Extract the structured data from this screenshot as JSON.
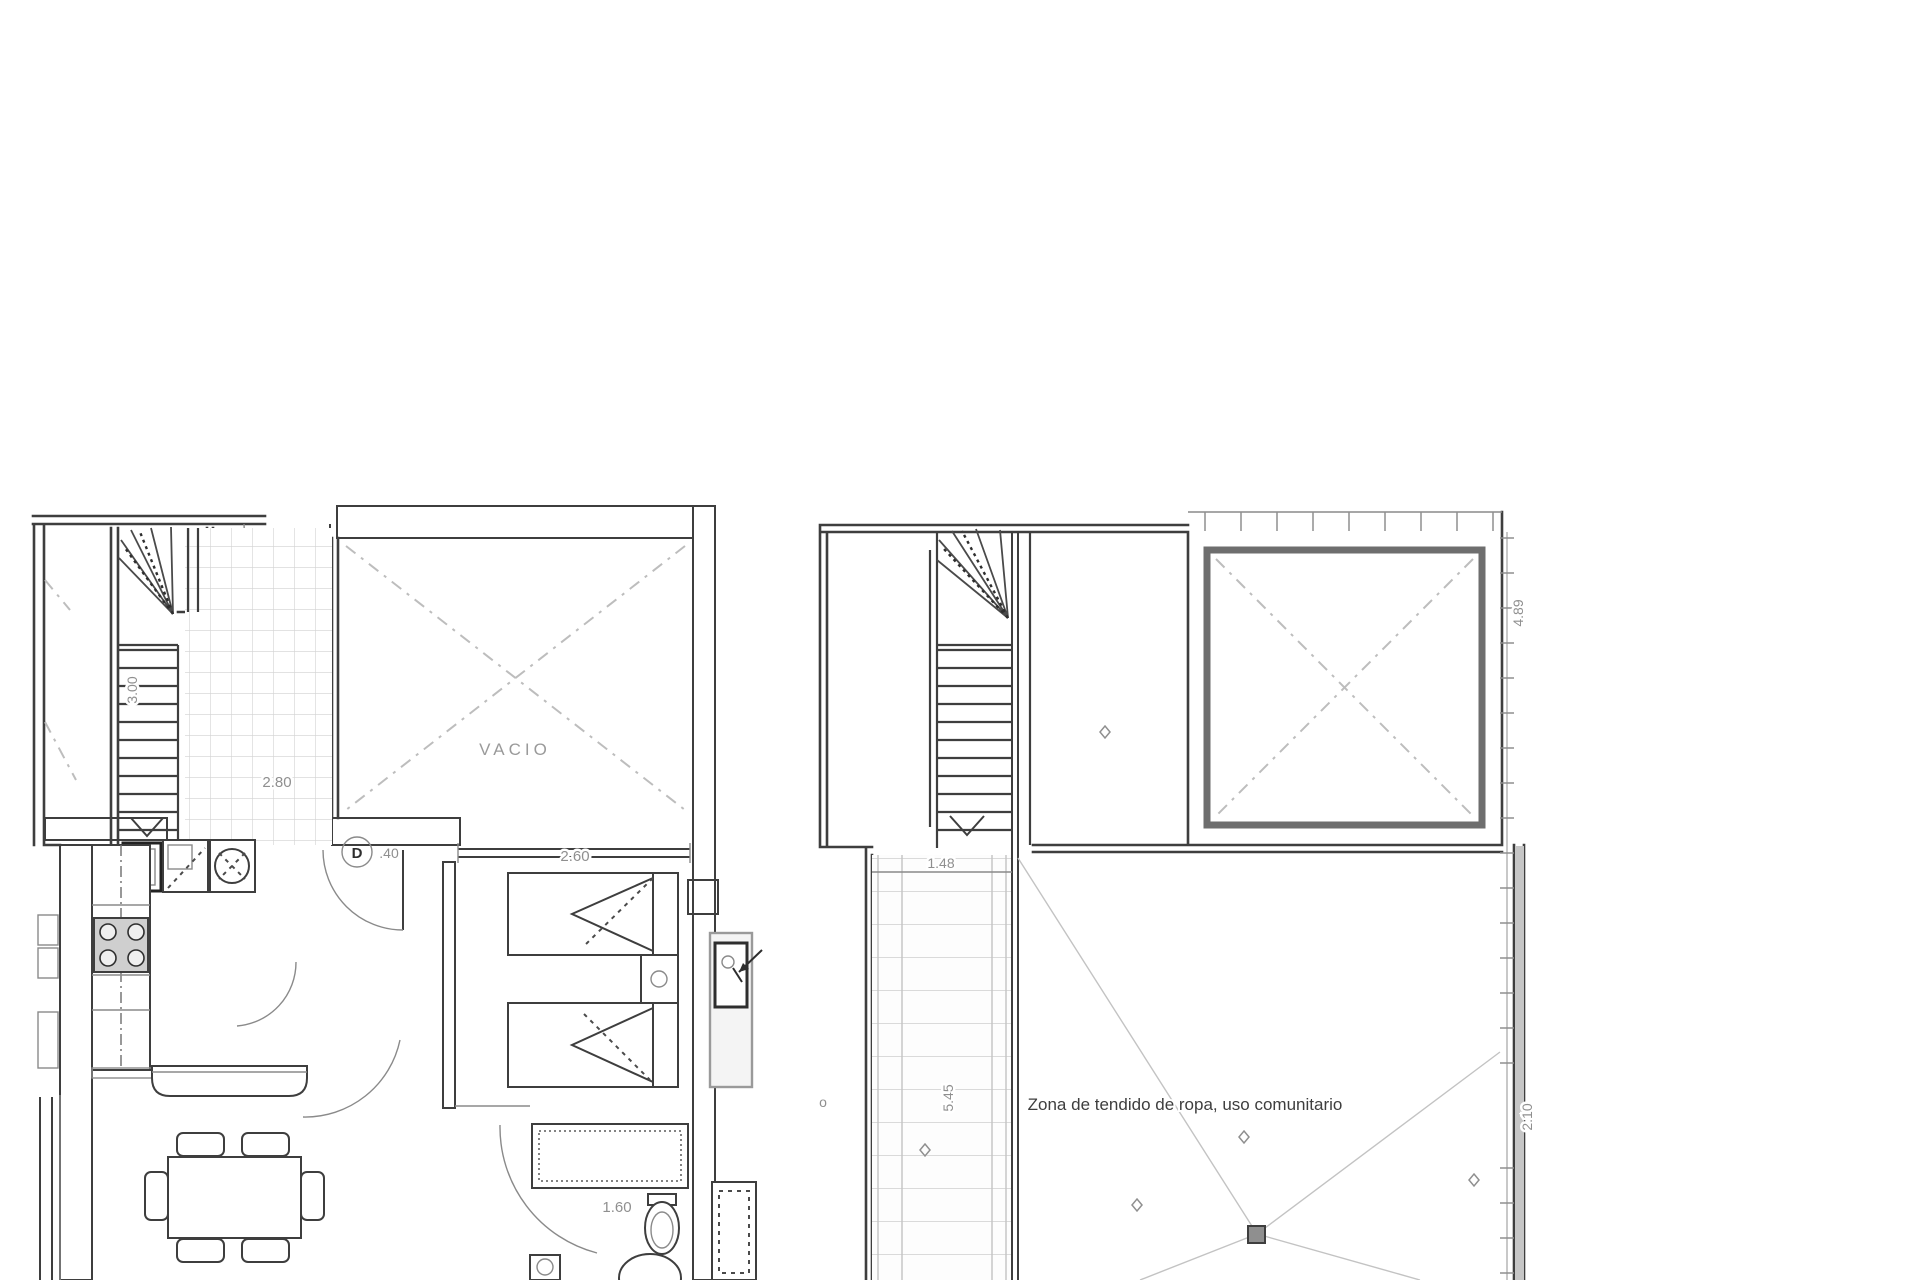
{
  "document": {
    "type": "architectural-floor-plan",
    "sheets": [
      "apartment-upper-floor",
      "roof-terrace-floor"
    ]
  },
  "colors": {
    "background": "#ffffff",
    "wall_line": "#3e3e3e",
    "faint_line": "#c3c3c3",
    "dim_text": "#8f8f8f",
    "zone_text": "#3e3e3e",
    "wall_fill_gray": "#c6c6c6"
  },
  "left_plan": {
    "vacio_label": "VACIO",
    "hall_dim": "2.80",
    "stair_dim": "3.00",
    "window_dim": "2.60",
    "door_tag": "D",
    "door_dim": ".40",
    "bath_dim": "1.60"
  },
  "right_plan": {
    "patio_width_dim": "1.48",
    "patio_length_dim": "5.45",
    "right_upper_dim": "4.89",
    "right_lower_dim": "2.10",
    "zone_label": "Zona de tendido de ropa, uso comunitario",
    "stray_label": "o"
  }
}
